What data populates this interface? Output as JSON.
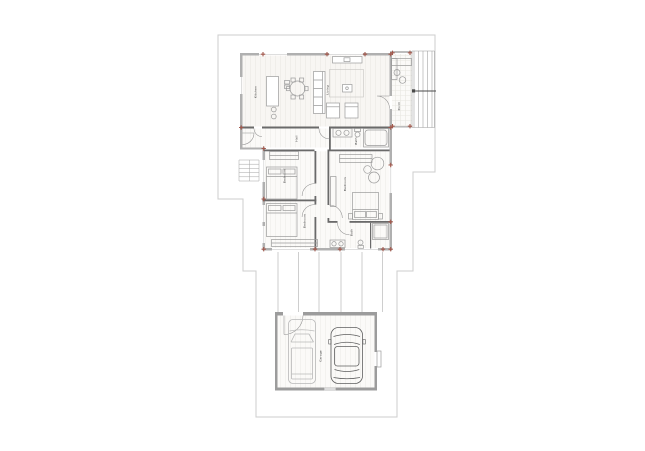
{
  "document": {
    "title": "Residential floor plan with garage",
    "drawing_type": "architectural plan view"
  },
  "plan": {
    "colors": {
      "property_line": "#cdcdcd",
      "exterior_wall": "#b0b0b0",
      "partition_wall": "#6a6a6a",
      "garage_wall": "#9c9c9c",
      "column_marker": "#a2584c",
      "furniture_line": "#9b9b9b",
      "label_text": "#3c3c3c",
      "driveway_line": "#c2c2c2"
    },
    "rooms": [
      {
        "id": "kitchen",
        "label": "Kitchen"
      },
      {
        "id": "living",
        "label": "Living"
      },
      {
        "id": "porch",
        "label": "Porch"
      },
      {
        "id": "hall",
        "label": "Hall"
      },
      {
        "id": "bath-top",
        "label": "Bath"
      },
      {
        "id": "bedroom-a",
        "label": "Bedroom"
      },
      {
        "id": "bedroom-b",
        "label": "Bedroom"
      },
      {
        "id": "master-bedroom",
        "label": "Bedroom"
      },
      {
        "id": "bath-lower",
        "label": "Bath"
      },
      {
        "id": "garage",
        "label": "Garage"
      }
    ],
    "features": {
      "cars_in_garage": 2,
      "exterior_stairs": "west side",
      "porch_steps": "east side"
    }
  }
}
